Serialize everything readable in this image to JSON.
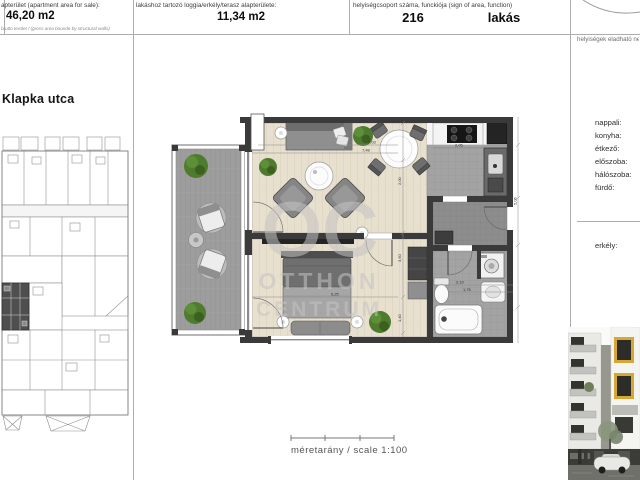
{
  "header": {
    "field1": {
      "label": "apterület (apartment area for sale):",
      "value": "46,20 m2",
      "note": "brutto terület / (gross area bounde by structural walls)"
    },
    "field2": {
      "label": "lakáshoz tartozó loggia/erkély/terasz alapterülete:",
      "value": "11,34 m2"
    },
    "field3": {
      "label": "helyiségcsoport száma, funckiója (sign of area, function)",
      "number": "216",
      "function_label": "lakás"
    }
  },
  "left_panel": {
    "street_label": "Klapka utca"
  },
  "right_panel": {
    "title": "helyiségek eladható ne",
    "rooms": [
      "nappali:",
      "konyha:",
      "étkező:",
      "előszoba:",
      "hálószoba:",
      "fürdő:"
    ],
    "balcony_label": "erkély:"
  },
  "plan": {
    "watermark": {
      "line1": "OC",
      "line2": "OTTHON",
      "line3": "CENTRUM"
    },
    "scale_label": "méretarány / scale 1:100",
    "dims": {
      "d1": "7,03",
      "d2": "7,48",
      "d3": "2,00",
      "d4": "3,50",
      "d5": "5,25",
      "d6": "2,10",
      "d7": "1,75",
      "d8": "2,05",
      "d9": "1,40",
      "d10": "5,06"
    }
  },
  "colors": {
    "wall": "#3a3a3a",
    "wood": "#e8e0cf",
    "deck": "#9d9d9d",
    "tile": "#a0a0a0",
    "plant": "#4f7b2f",
    "watermark": "#c4c4c4",
    "accent_yellow": "#d7a734"
  }
}
